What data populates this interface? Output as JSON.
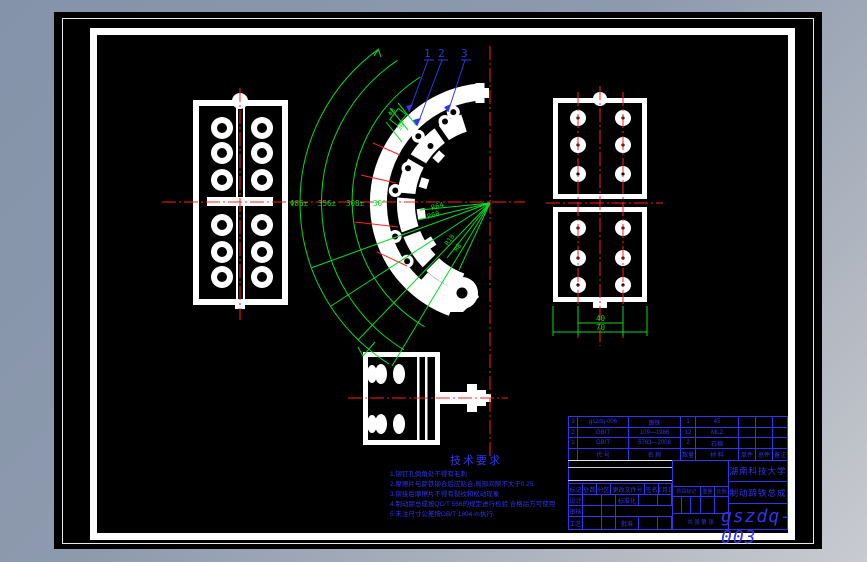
{
  "colors": {
    "annotation_blue": "#3333f2",
    "dimension_green": "#00dd22",
    "centerline_red": "#ff2020",
    "geometry_white": "#ffffff"
  },
  "callouts": {
    "n1": "1",
    "n2": "2",
    "n3": "3"
  },
  "center_view": {
    "arc_labels": {
      "a": "Φ86±",
      "b": "356±",
      "c": "308±",
      "d": "30°"
    },
    "radius_labels": {
      "r64": "R64",
      "r68": "R68"
    },
    "lobe_labels": {
      "r10": "R10",
      "r8": "R8"
    },
    "detail_labels": {
      "d1": "Φ8",
      "d2": "30°"
    }
  },
  "right_view": {
    "dim_inner": "40",
    "dim_outer": "70"
  },
  "tech": {
    "title": "技术要求",
    "lines": [
      "1.铆钉孔倒角处不得有毛刺",
      "2.摩擦片与蹄铁铆合后应贴合,局部间隙不大于0.25",
      "3.铆接后摩擦片不得有裂纹和松动现象",
      "4.制动蹄总成按QC/T 556的规定进行检验,合格后方可使用",
      "5.未注尺寸公差按GB/T 1804-m执行."
    ]
  },
  "bom": {
    "headers": [
      "",
      "代 号",
      "名 称",
      "数量",
      "材 料",
      "单件",
      "总件",
      "备注"
    ],
    "rows": [
      [
        "3",
        "gszdq-006",
        "蹄铁",
        "1",
        "45",
        "",
        "",
        ""
      ],
      [
        "2",
        "GB/T",
        "109—1986",
        "12",
        "ML2",
        "",
        "",
        ""
      ],
      [
        "1",
        "GB/T",
        "5763—2008",
        "2",
        "石棉",
        "",
        "",
        ""
      ]
    ]
  },
  "title_block": {
    "school": "湖南科技大学",
    "drawing_title": "制动蹄铁总成",
    "drawing_number": "gszdq-003",
    "row1": [
      "标记",
      "处数",
      "分区",
      "更改文件号",
      "签名",
      "年月日"
    ],
    "row2_design": "设计",
    "row2_std": "标准化",
    "row3_check": "审核",
    "row4_craft": "工艺",
    "row4_approve": "批准",
    "mid": [
      "阶段标记",
      "重量",
      "比例"
    ],
    "sheets": "共 张 第 张"
  }
}
